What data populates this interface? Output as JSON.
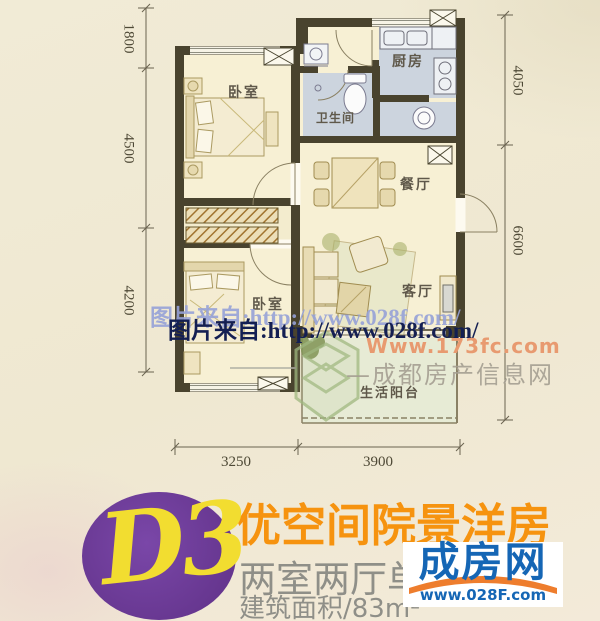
{
  "floorplan": {
    "rooms": [
      {
        "id": "bedroom-1",
        "label": "卧室"
      },
      {
        "id": "kitchen",
        "label": "厨房"
      },
      {
        "id": "bathroom",
        "label": "卫生间"
      },
      {
        "id": "dining",
        "label": "餐厅"
      },
      {
        "id": "living",
        "label": "客厅"
      },
      {
        "id": "bedroom-2",
        "label": "卧室"
      },
      {
        "id": "balcony",
        "label": "生活阳台"
      }
    ],
    "dimensions": {
      "left": [
        {
          "value": "1800"
        },
        {
          "value": "4500"
        },
        {
          "value": "4200"
        }
      ],
      "right": [
        {
          "value": "4050"
        },
        {
          "value": "6600"
        }
      ],
      "bottom": [
        {
          "value": "3250"
        },
        {
          "value": "3900"
        }
      ]
    }
  },
  "watermarks": {
    "source_light": "图片来自:http://www.028f.com/",
    "source_dark": "图片来自:http://www.028f.com/",
    "site_url": "Www.173fc.com",
    "site_name": "—成都房产信息网"
  },
  "footer": {
    "unit_code": "D3",
    "title": "优空间院景洋房",
    "layout": "两室两厅单",
    "area": "建筑面积/83m²",
    "logo_name": "成房网",
    "logo_url": "www.028F.com"
  },
  "colors": {
    "accent_orange": "#f6930f",
    "badge_purple": "#66368f",
    "badge_yellow": "#f2dd30",
    "logo_blue": "#1566b5",
    "logo_roof_orange": "#ee7d2d",
    "wall": "#49432e",
    "wet_floor": "#ccd4de",
    "room_floor": "#f7f0d4",
    "balcony_floor": "#e7ebd5"
  }
}
